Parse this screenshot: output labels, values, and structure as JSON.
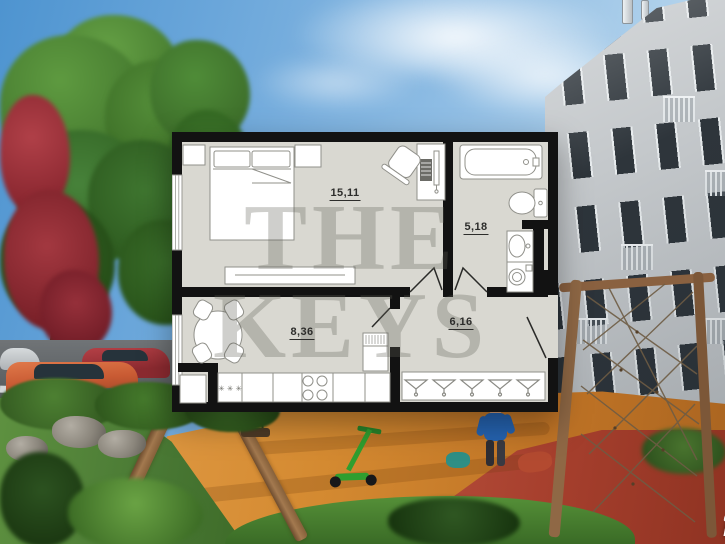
{
  "floorplan": {
    "rooms": [
      {
        "name": "bedroom",
        "area_label": "15,11"
      },
      {
        "name": "bathroom",
        "area_label": "5,18"
      },
      {
        "name": "kitchen-living",
        "area_label": "8,36"
      },
      {
        "name": "hallway",
        "area_label": "6,16"
      }
    ],
    "hob_symbol": "✳ ✳ ✳",
    "icons": [
      "bed",
      "pillow",
      "nightstand",
      "wardrobe",
      "desk",
      "office-chair",
      "dresser",
      "bathtub",
      "toilet",
      "sink",
      "washing-machine",
      "dining-table",
      "chair",
      "kitchen-counter",
      "hob-burners",
      "fridge",
      "coat-hanger",
      "door-leaf",
      "window"
    ],
    "colors": {
      "wall": "#121212",
      "floor": "#d9d8d1",
      "furniture_fill": "#ffffff",
      "furniture_stroke": "#90908a",
      "label": "#2d2d2b"
    }
  },
  "watermark": {
    "line1": "THE",
    "line2": "KEYS",
    "color": "rgba(96,96,86,0.30)"
  },
  "logo": {
    "text": "Restate",
    "color": "#ffffff"
  },
  "scene": {
    "sky": "#6aa6da",
    "building_facade": "#c4c8cb",
    "window_glass": "#2e353b",
    "playground_surface": "#d48a31",
    "rubber_red": "#a63f2d",
    "grass": "#4e8136",
    "tree_green": "#47823a",
    "tree_red": "#9c2c36",
    "wood": "#8f6845",
    "asphalt": "#5f6366"
  }
}
